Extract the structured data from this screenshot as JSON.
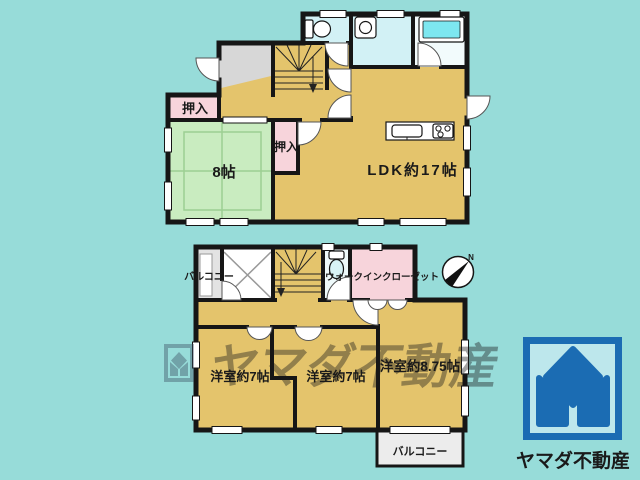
{
  "background_color": "#97dcd9",
  "colors": {
    "wall": "#161616",
    "room_floor_tan": "#e4c46c",
    "tatami_green": "#c9ecc0",
    "closet_pink": "#f7d4db",
    "water_room_cyan": "#d2f1f5",
    "bathtub_cyan": "#7de7f0",
    "genkan_gray": "#d7d7d7",
    "balcony_gray": "#e3e3e3",
    "logo_blue": "#1b6cb3",
    "watermark_slate": "#3a4c61"
  },
  "floor1": {
    "rooms": {
      "ldk": {
        "label": "LDK約17帖"
      },
      "tatami": {
        "label": "8帖"
      },
      "closet_upper": {
        "label": "押入"
      },
      "closet_lower": {
        "label": "押入"
      }
    }
  },
  "floor2": {
    "rooms": {
      "balcony_top": {
        "label": "バルコニー"
      },
      "walk_in_closet": {
        "label": "ウォークインクローゼット"
      },
      "bedroom_left": {
        "label": "洋室約7帖"
      },
      "bedroom_middle": {
        "label": "洋室約7帖"
      },
      "bedroom_right": {
        "label": "洋室約8.75帖"
      },
      "balcony_bottom": {
        "label": "バルコニー"
      }
    }
  },
  "compass": {
    "north_label": "N"
  },
  "watermark": {
    "text": "ヤマダ不動産"
  },
  "logo": {
    "company_name": "ヤマダ不動産"
  }
}
